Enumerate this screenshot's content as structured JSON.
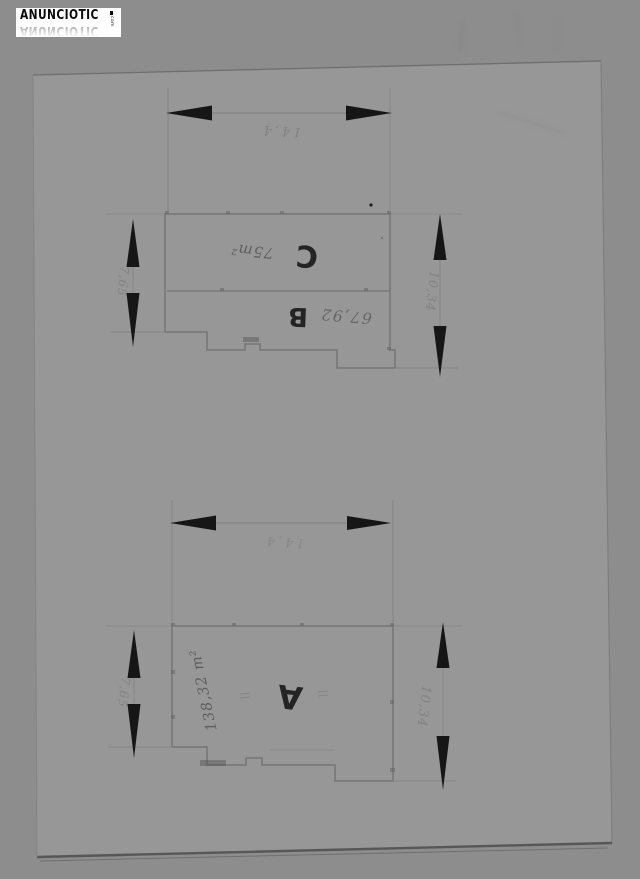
{
  "watermark": {
    "brand": "ANUNCIOTIC",
    "tld": "com"
  },
  "upper_plan": {
    "width_label": "14,4",
    "left_height_label": "7,65",
    "right_height_label": "10,34",
    "room_c_label": "C",
    "room_c_area": "75m²",
    "room_b_label": "B",
    "room_b_area": "67,92"
  },
  "lower_plan": {
    "width_label": "14,4",
    "left_height_label": "7,65",
    "right_height_label": "10,34",
    "room_a_label": "A",
    "room_a_area": "138,32 m²"
  },
  "colors": {
    "background": "#8d8d8d",
    "paper": "#979797",
    "ink": "#161616",
    "line_faint": "#7c7c7c",
    "watermark_bg": "#ffffff",
    "watermark_text": "#0a0a0a"
  }
}
